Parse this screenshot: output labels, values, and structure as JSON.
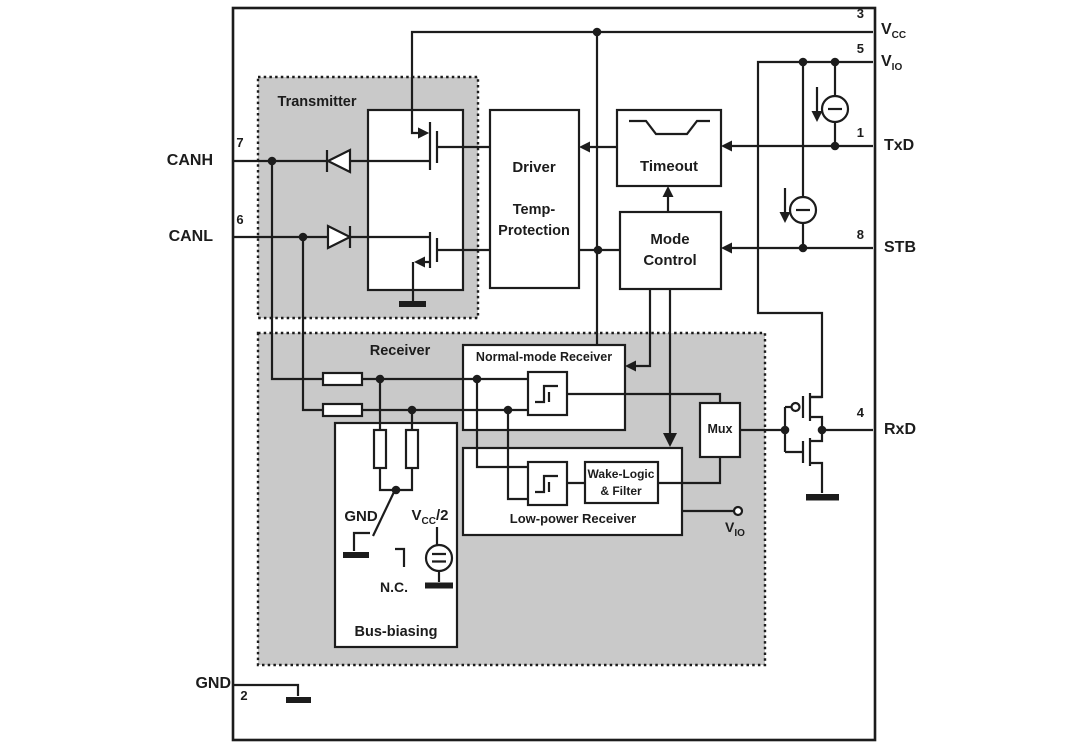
{
  "diagram": {
    "pins": {
      "vcc": {
        "number": "3",
        "label": "V",
        "label_sub": "CC"
      },
      "vio": {
        "number": "5",
        "label": "V",
        "label_sub": "IO"
      },
      "txd": {
        "number": "1",
        "label": "TxD"
      },
      "stb": {
        "number": "8",
        "label": "STB"
      },
      "rxd": {
        "number": "4",
        "label": "RxD"
      },
      "canh": {
        "number": "7",
        "label": "CANH"
      },
      "canl": {
        "number": "6",
        "label": "CANL"
      },
      "gnd": {
        "number": "2",
        "label": "GND"
      }
    },
    "blocks": {
      "transmitter": {
        "label": "Transmitter"
      },
      "receiver": {
        "label": "Receiver"
      },
      "driver": {
        "title": "Driver",
        "temp_line1": "Temp-",
        "temp_line2": "Protection"
      },
      "timeout": {
        "label": "Timeout"
      },
      "mode_control": {
        "line1": "Mode",
        "line2": "Control"
      },
      "normal_mode_receiver": {
        "label": "Normal-mode Receiver"
      },
      "low_power_receiver": {
        "label": "Low-power Receiver"
      },
      "wake_logic": {
        "line1": "Wake-Logic",
        "line2": "& Filter"
      },
      "mux": {
        "label": "Mux"
      },
      "bus_biasing": {
        "label": "Bus-biasing"
      }
    },
    "bias_switch": {
      "gnd_label": "GND",
      "vcc_half": {
        "main": "V",
        "sub": "CC",
        "suffix": "/2"
      },
      "nc_label": "N.C."
    },
    "vio_terminal": {
      "main": "V",
      "sub": "IO"
    },
    "colors": {
      "box_gray": "#c9c9c9",
      "line": "#1c1c1c"
    }
  }
}
